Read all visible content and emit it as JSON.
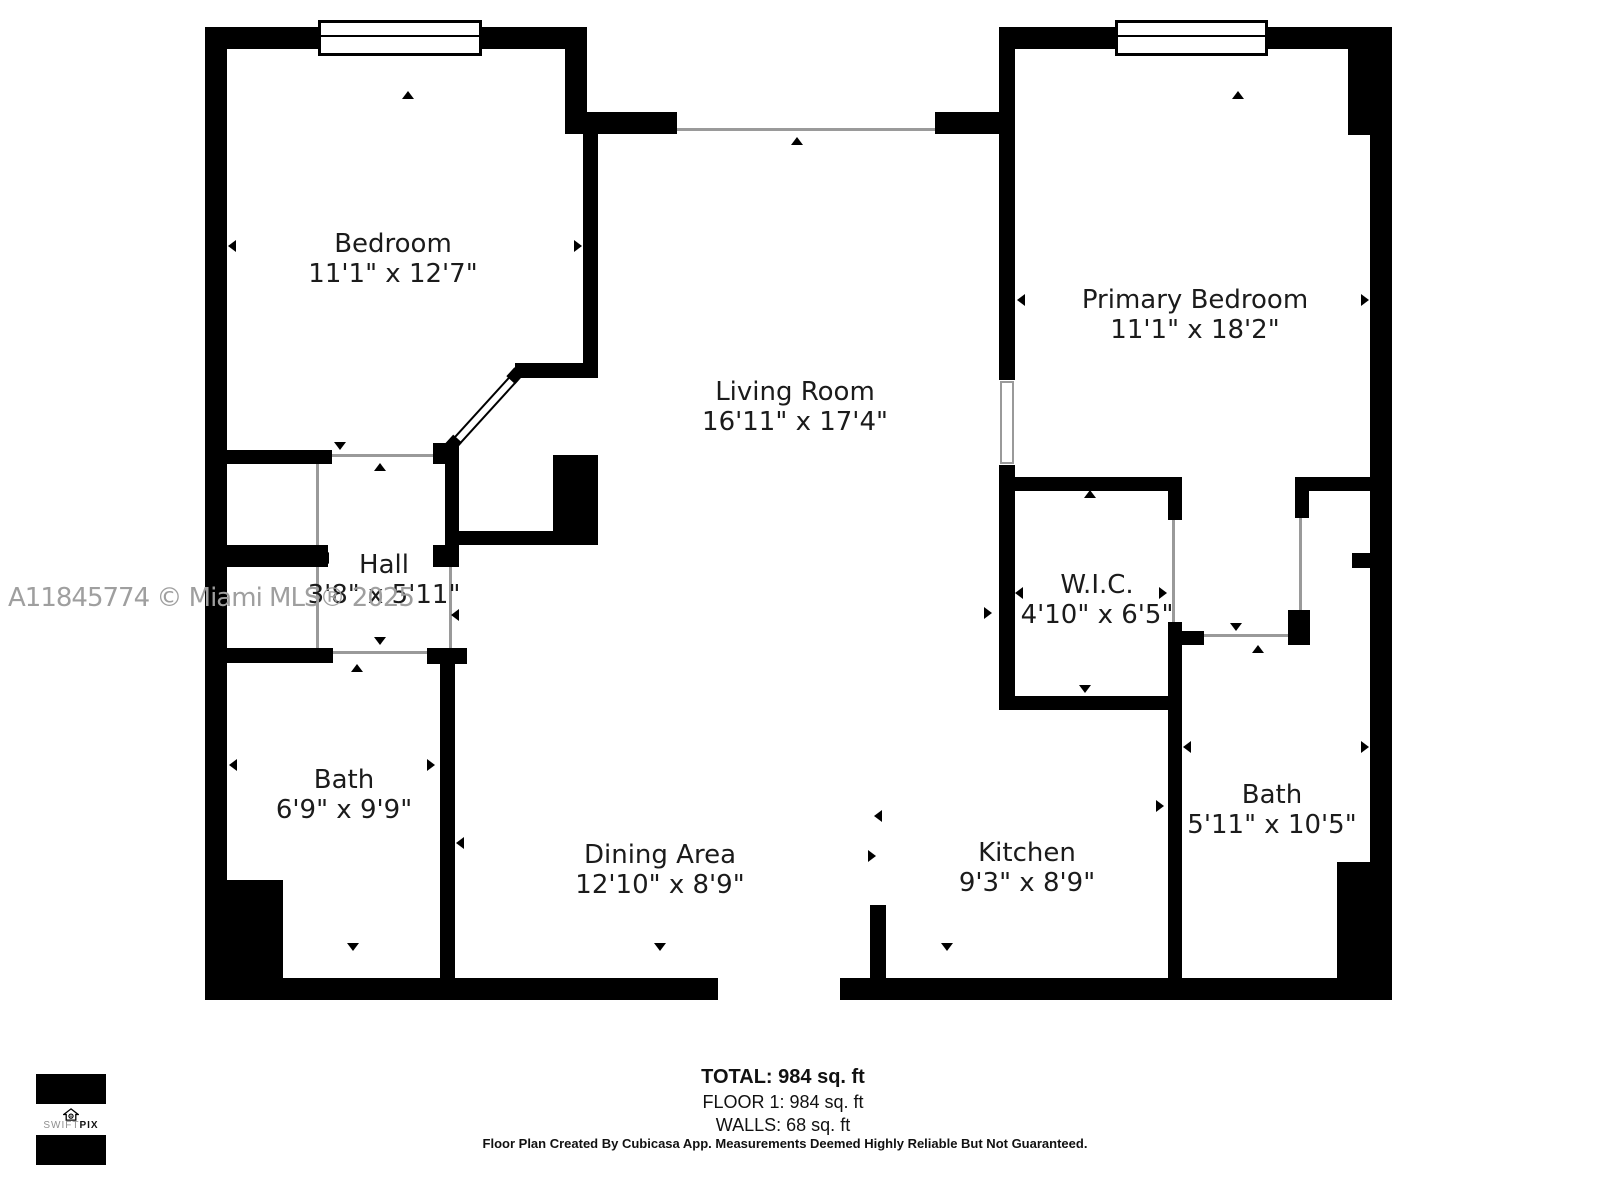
{
  "watermark": "A11845774 © Miami MLS® 2025",
  "rooms": {
    "bedroom": {
      "name": "Bedroom",
      "dims": "11'1\" x 12'7\""
    },
    "primary_bedroom": {
      "name": "Primary Bedroom",
      "dims": "11'1\" x 18'2\""
    },
    "living_room": {
      "name": "Living Room",
      "dims": "16'11\" x 17'4\""
    },
    "hall": {
      "name": "Hall",
      "dims": "3'8\" x 5'11\""
    },
    "wic": {
      "name": "W.I.C.",
      "dims": "4'10\" x 6'5\""
    },
    "bath_left": {
      "name": "Bath",
      "dims": "6'9\" x 9'9\""
    },
    "bath_right": {
      "name": "Bath",
      "dims": "5'11\" x 10'5\""
    },
    "dining_area": {
      "name": "Dining Area",
      "dims": "12'10\" x 8'9\""
    },
    "kitchen": {
      "name": "Kitchen",
      "dims": "9'3\" x 8'9\""
    }
  },
  "summary": {
    "total": "TOTAL: 984 sq. ft",
    "floor": "FLOOR 1: 984 sq. ft",
    "walls": "WALLS: 68 sq. ft"
  },
  "disclaimer": "Floor Plan Created By Cubicasa App. Measurements Deemed Highly Reliable But Not Guaranteed.",
  "logo": {
    "brand_light": "SWIFT",
    "brand_bold": "PIX",
    "icon": "house-icon"
  },
  "colors": {
    "wall": "#000000",
    "label": "#1b1b1b",
    "watermark": "#9f9f9f",
    "opening_line": "#9a9a9a"
  }
}
